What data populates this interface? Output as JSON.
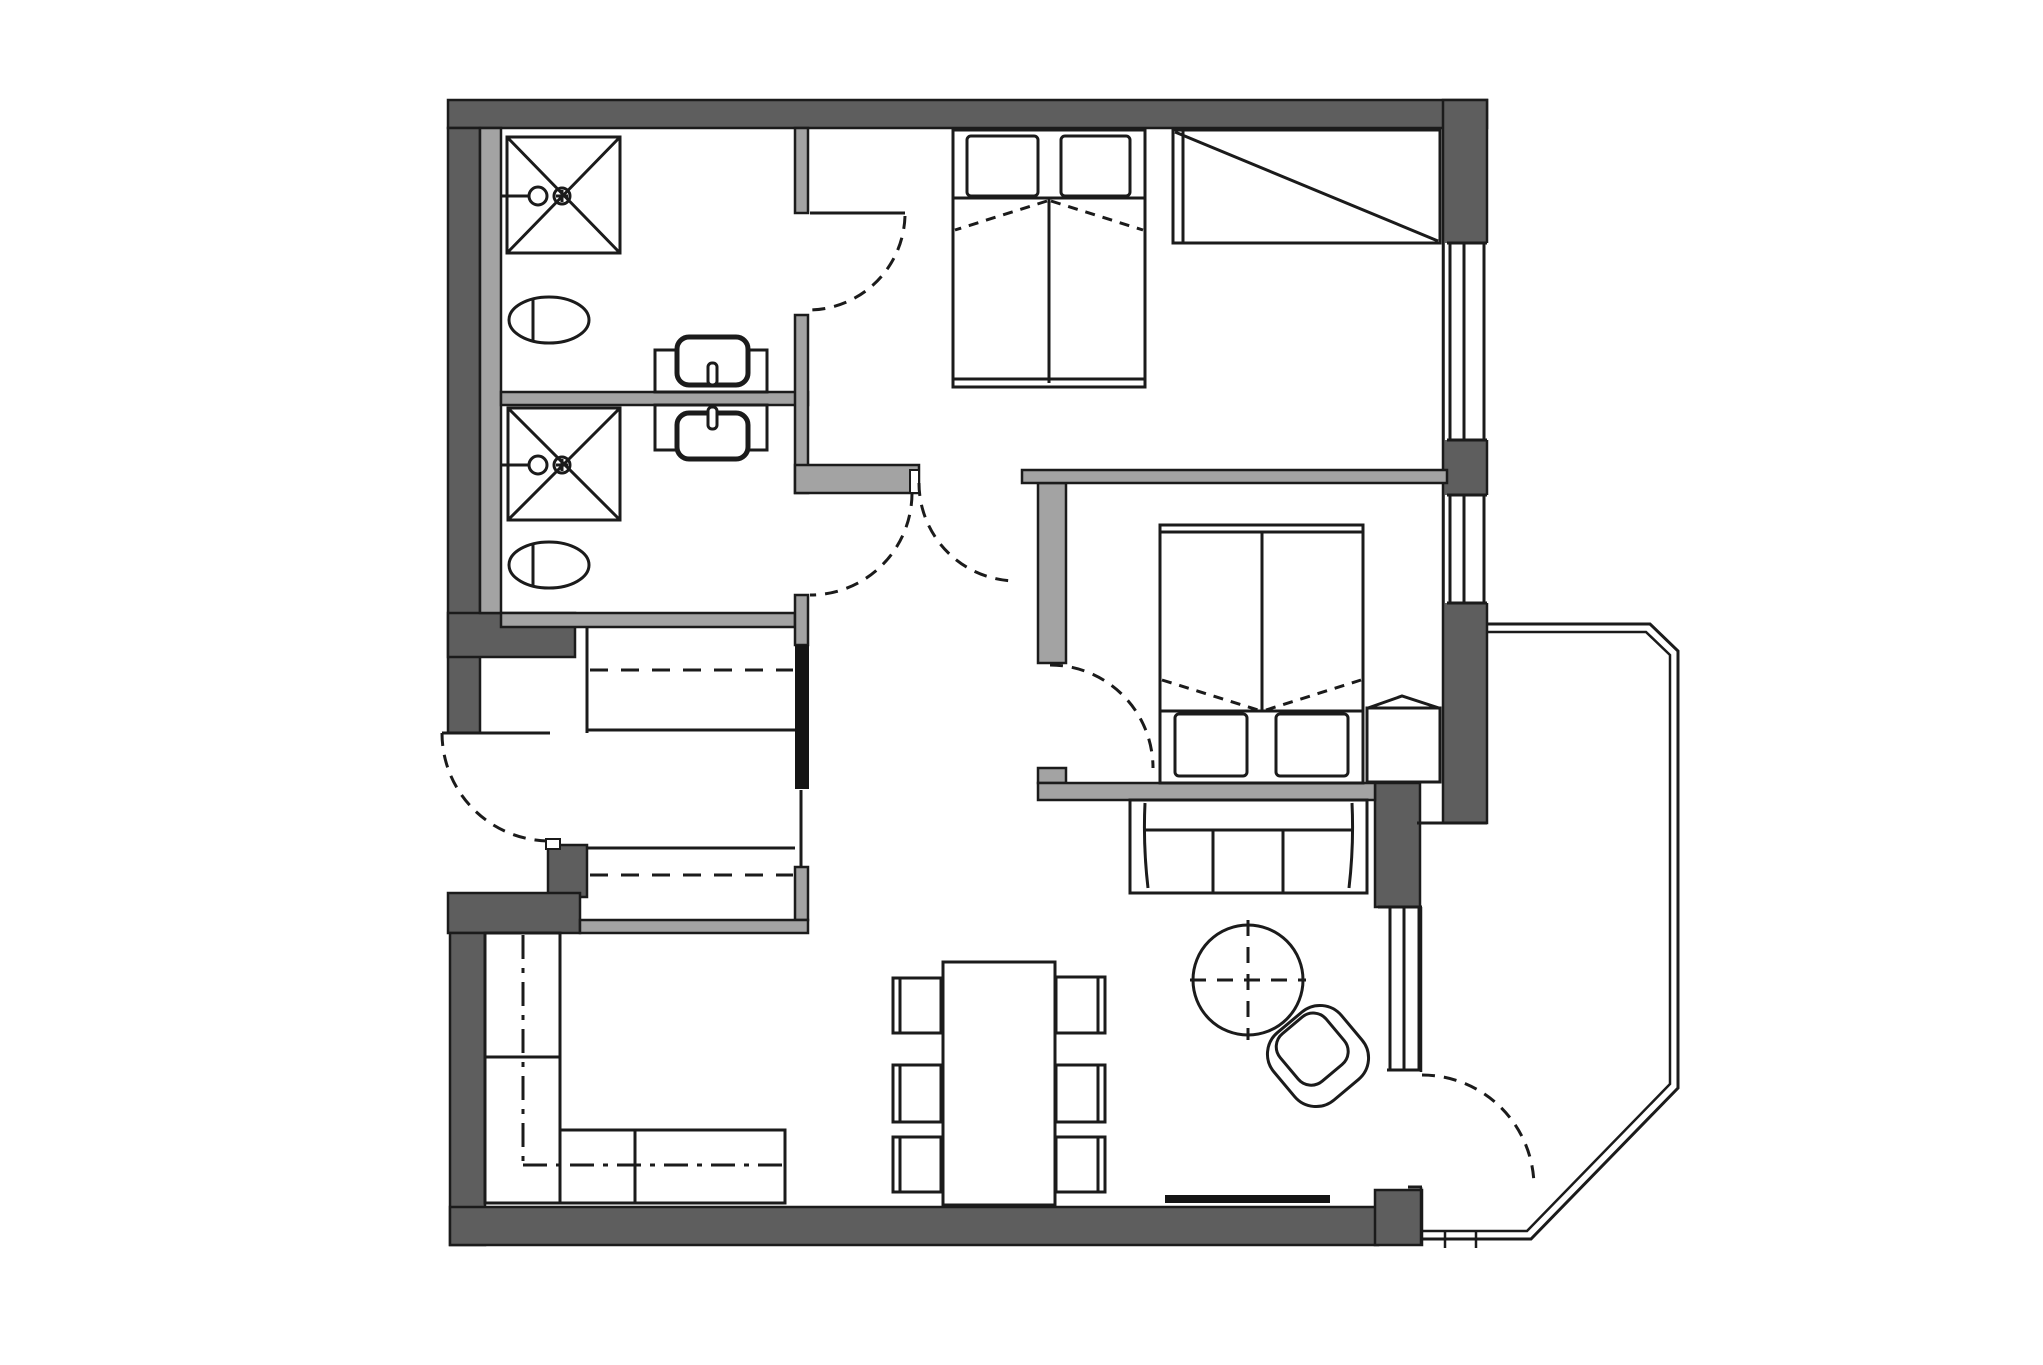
{
  "document": {
    "kind": "architectural-floor-plan",
    "visible_text": []
  },
  "colors": {
    "background": "#ffffff",
    "wall_dark": "#5e5e5e",
    "wall_light": "#a3a3a3",
    "line": "#1b1b1b",
    "fixture_fill": "#ffffff",
    "door_leaf_bar": "#141414"
  },
  "rooms": {
    "bathroom_top": [
      "shower",
      "shower-head",
      "toilet",
      "washbasin"
    ],
    "bathroom_bottom": [
      "shower",
      "shower-head",
      "toilet",
      "washbasin"
    ],
    "bedroom_1": [
      "double-bed",
      "pillows",
      "wardrobe"
    ],
    "bedroom_2": [
      "double-bed",
      "pillows",
      "nightstand"
    ],
    "hall": [
      "closet-dashed",
      "closet-dashed",
      "sliding-door-bar"
    ],
    "living_dining": [
      "sofa-3seat",
      "round-table",
      "armchair",
      "dining-table",
      "six-chairs",
      "corner-sofa",
      "threshold-strip"
    ],
    "balcony": [
      "railing"
    ]
  },
  "doors": [
    "entrance-door",
    "bathroom-1-door",
    "bathroom-2-door",
    "bedroom-1-door",
    "bedroom-2-door",
    "balcony-door"
  ],
  "windows": [
    "bedroom-1-window",
    "bedroom-2-window",
    "living-room-window"
  ]
}
